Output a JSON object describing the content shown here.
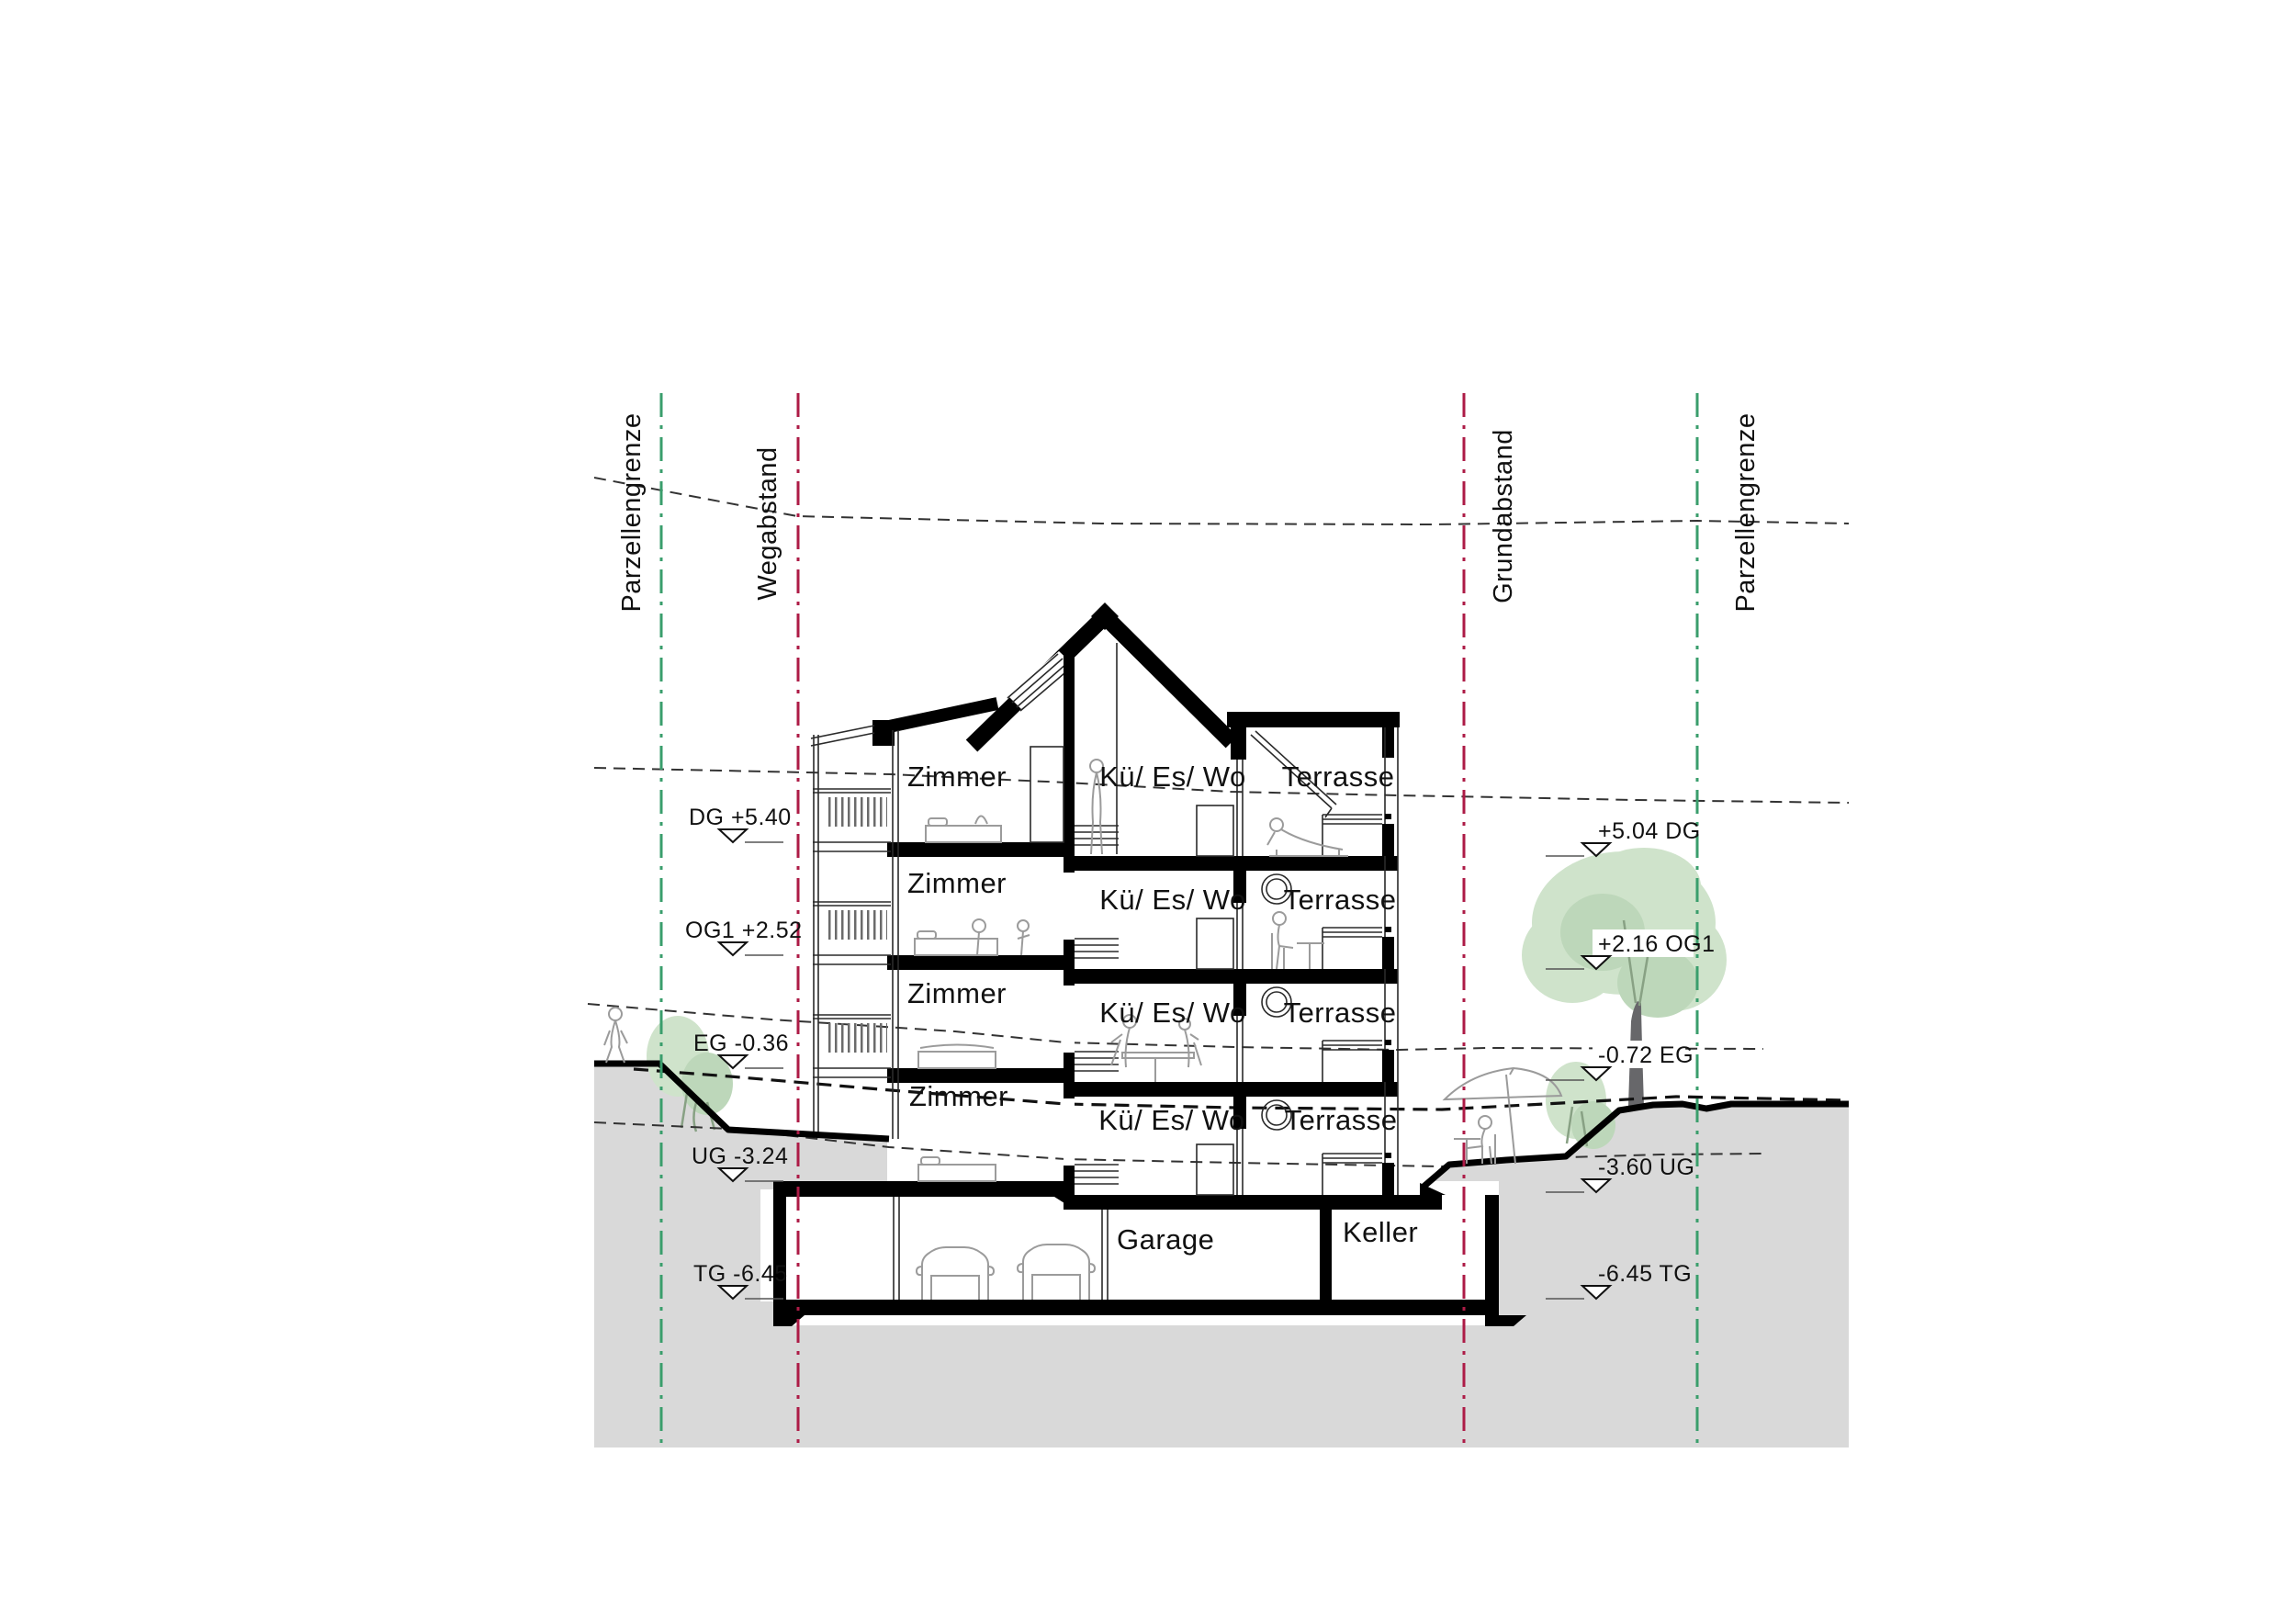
{
  "drawing_title": "Building cross-section (Querschnitt)",
  "boundaries": {
    "left": [
      {
        "label": "Parzellengrenze"
      },
      {
        "label": "Wegabstand"
      }
    ],
    "right": [
      {
        "label": "Grundabstand"
      },
      {
        "label": "Parzellengrenze"
      }
    ]
  },
  "levels": {
    "left": [
      {
        "label": "DG +5.40"
      },
      {
        "label": "OG1 +2.52"
      },
      {
        "label": "EG -0.36"
      },
      {
        "label": "UG -3.24"
      },
      {
        "label": "TG -6.45"
      }
    ],
    "right": [
      {
        "label": "+5.04 DG"
      },
      {
        "label": "+2.16 OG1"
      },
      {
        "label": "-0.72 EG"
      },
      {
        "label": "-3.60 UG"
      },
      {
        "label": "-6.45 TG"
      }
    ]
  },
  "floors": [
    {
      "left": "Zimmer",
      "center": "Kü/ Es/ Wo",
      "right": "Terrasse"
    },
    {
      "left": "Zimmer",
      "center": "Kü/ Es/ Wo",
      "right": "Terrasse"
    },
    {
      "left": "Zimmer",
      "center": "Kü/ Es/ Wo",
      "right": "Terrasse"
    },
    {
      "left": "Zimmer",
      "center": "Kü/ Es/ Wo",
      "right": "Terrasse"
    }
  ],
  "basement": {
    "garage": "Garage",
    "keller": "Keller"
  },
  "colors": {
    "background": "#ffffff",
    "ground": "#d9d9d9",
    "ink": "#000000",
    "thin_line": "#2a2a2a",
    "figure_line": "#9b9b9b",
    "boundary_green": "#3a9e6c",
    "boundary_red": "#ad1b46",
    "canopy_light": "#cfe3cb",
    "canopy_dark": "#bdd7ba",
    "trunk": "#67676a"
  }
}
